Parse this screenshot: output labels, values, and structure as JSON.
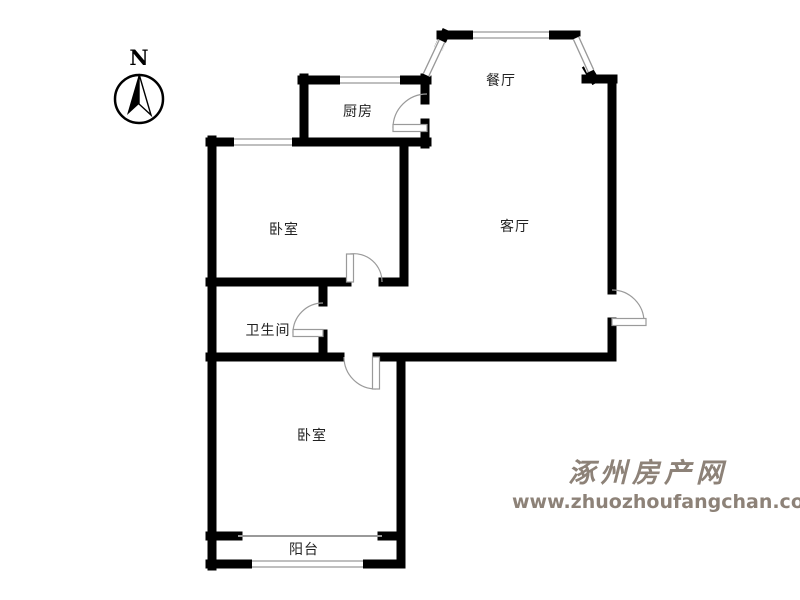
{
  "meta": {
    "type": "apartment-floor-plan",
    "background_color": "#ffffff",
    "wall_color": "#000000",
    "window_line_color": "#999999",
    "door_line_color": "#9a9a9a",
    "label_color": "#222222"
  },
  "compass": {
    "label": "N"
  },
  "rooms": [
    {
      "id": "dining-room",
      "name": "餐厅"
    },
    {
      "id": "kitchen",
      "name": "厨房"
    },
    {
      "id": "bedroom-1",
      "name": "卧室"
    },
    {
      "id": "living-room",
      "name": "客厅"
    },
    {
      "id": "bathroom",
      "name": "卫生间"
    },
    {
      "id": "bedroom-2",
      "name": "卧室"
    },
    {
      "id": "balcony",
      "name": "阳台"
    }
  ],
  "watermark": {
    "site_name": "涿州房产网",
    "site_url": "www.zhuozhoufangchan.com",
    "color": "#8d8278"
  }
}
